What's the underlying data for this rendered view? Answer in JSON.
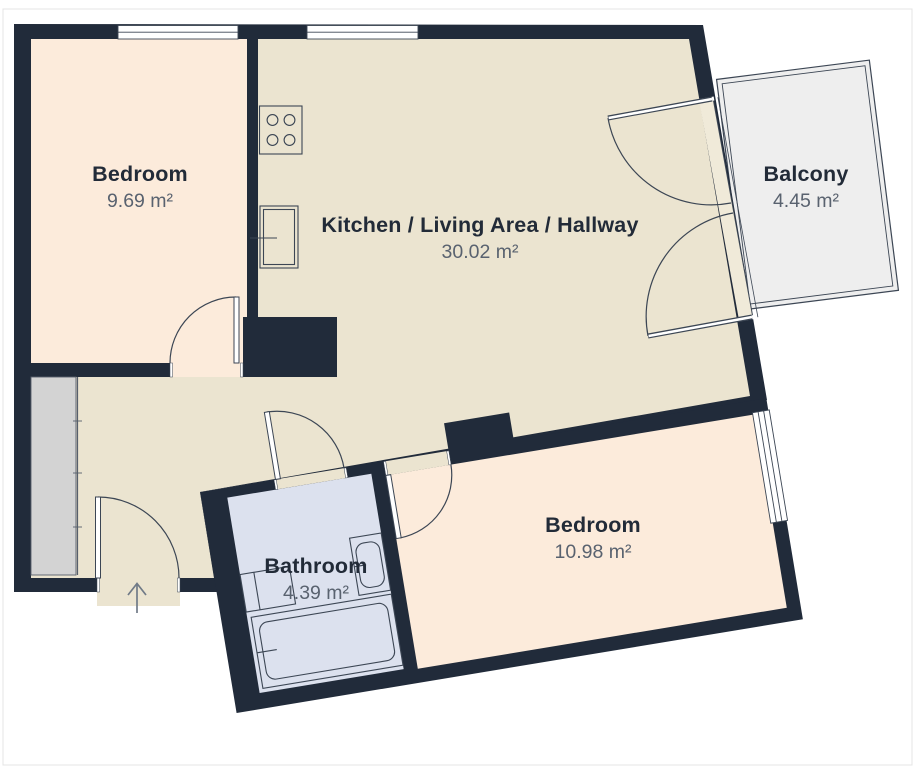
{
  "floorplan": {
    "title": "Apartment floor plan",
    "rooms": [
      {
        "id": "bedroom-1",
        "name": "Bedroom",
        "area": "9.69 m²"
      },
      {
        "id": "kitchen-living-hallway",
        "name": "Kitchen / Living Area / Hallway",
        "area": "30.02 m²"
      },
      {
        "id": "balcony",
        "name": "Balcony",
        "area": "4.45 m²"
      },
      {
        "id": "bedroom-2",
        "name": "Bedroom",
        "area": "10.98 m²"
      },
      {
        "id": "bathroom",
        "name": "Bathroom",
        "area": "4.39 m²"
      }
    ],
    "fixtures": [
      "stove",
      "kitchen-sink",
      "wardrobe",
      "washbasin",
      "toilet",
      "bathtub"
    ],
    "entrance": {
      "symbol": "arrow-up"
    },
    "colors": {
      "wall": "#212b3a",
      "floor_living": "#ebe4d0",
      "floor_bedroom": "#fcebdb",
      "floor_bathroom": "#dce1ee",
      "floor_balcony": "#eeeeee",
      "wardrobe_fill": "#d3d3d3",
      "line": "#3c4654",
      "text_primary": "#222b38",
      "text_secondary": "#59626f",
      "background": "#ffffff"
    }
  }
}
